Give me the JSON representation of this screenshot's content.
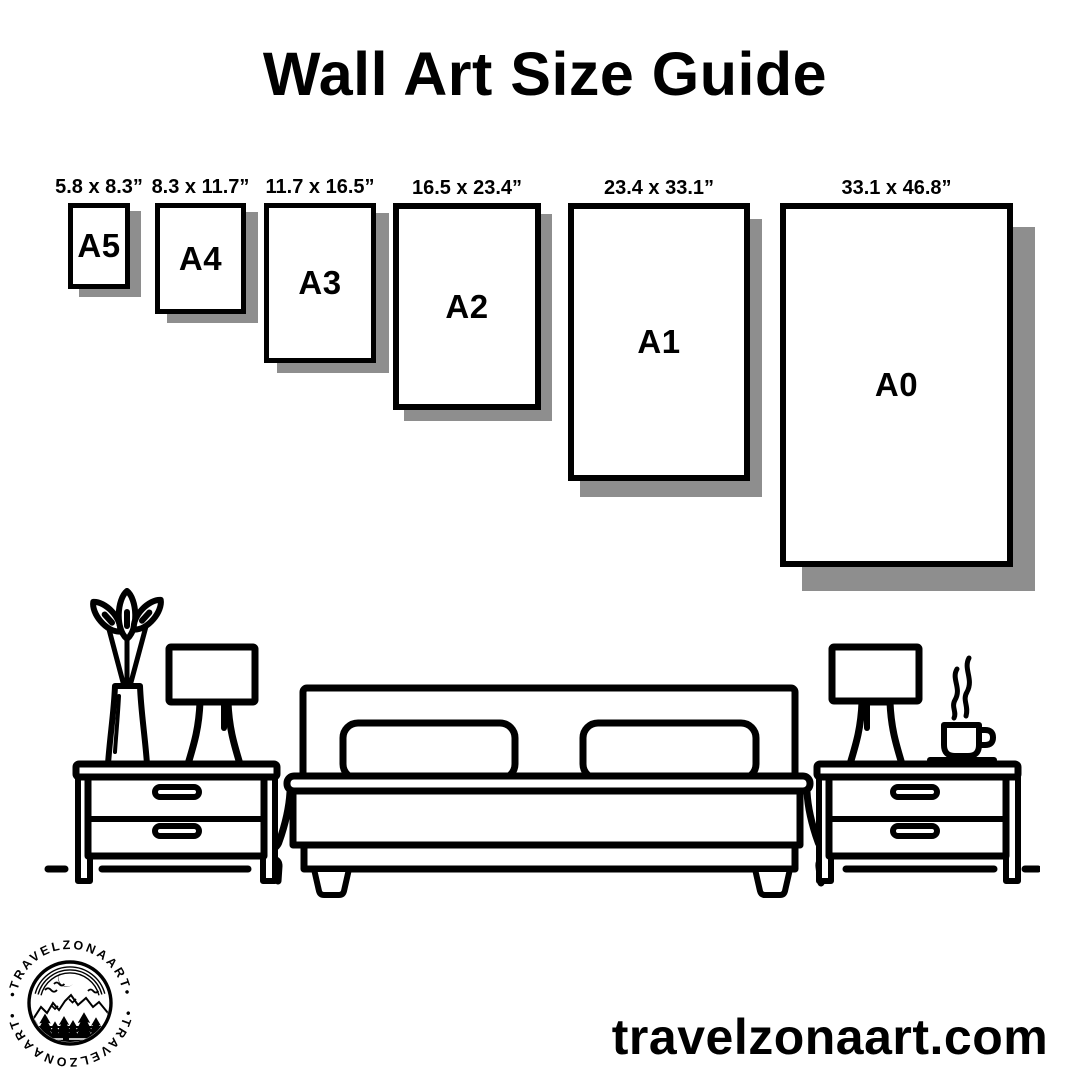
{
  "page": {
    "title": "Wall Art Size Guide"
  },
  "size_guide": {
    "frames": [
      {
        "code": "A5",
        "dimensions_label": "5.8 x 8.3”"
      },
      {
        "code": "A4",
        "dimensions_label": "8.3 x 11.7”"
      },
      {
        "code": "A3",
        "dimensions_label": "11.7 x 16.5”"
      },
      {
        "code": "A2",
        "dimensions_label": "16.5 x 23.4”"
      },
      {
        "code": "A1",
        "dimensions_label": "23.4 x 33.1”"
      },
      {
        "code": "A0",
        "dimensions_label": "33.1 x 46.8”"
      }
    ]
  },
  "footer": {
    "website": "travelzonaart.com",
    "logo": {
      "arc_text_top": "•TRAVELZONAART•",
      "arc_text_bottom": "•TRAVELZONAART•"
    }
  },
  "palette": {
    "ink": "#000000",
    "paper": "#ffffff",
    "frame_shadow": "#8e8e8e"
  }
}
